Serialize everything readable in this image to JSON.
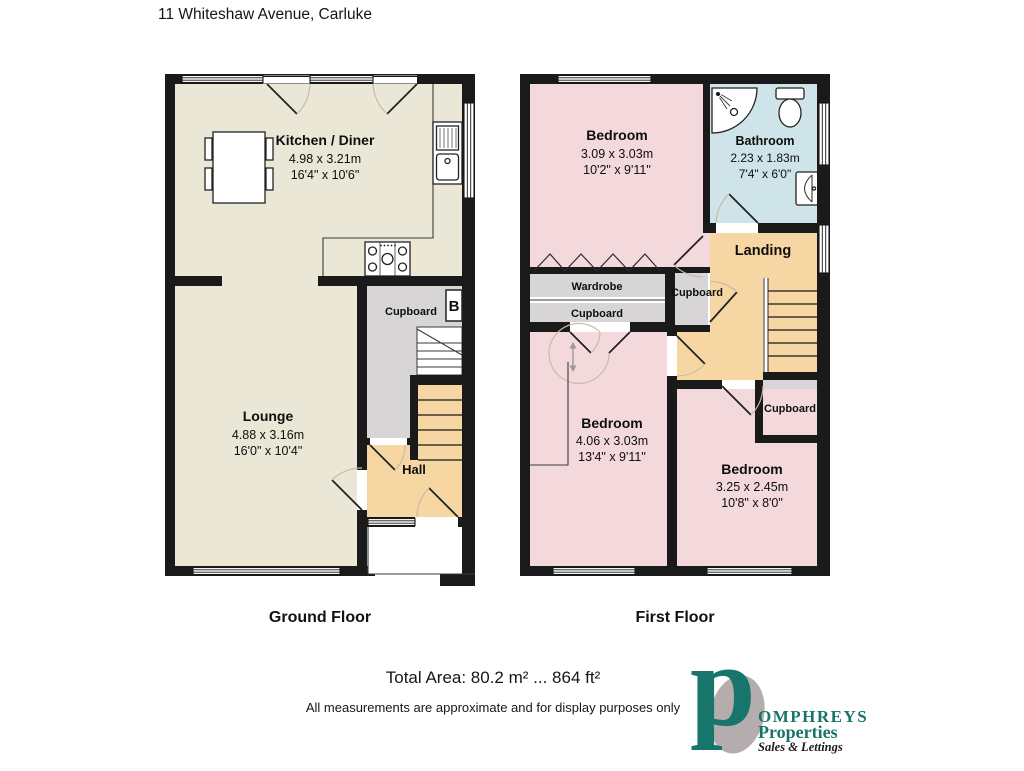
{
  "title": "11 Whiteshaw Avenue, Carluke",
  "ground": {
    "label": "Ground Floor",
    "kitchen_name": "Kitchen / Diner",
    "kitchen_metric": "4.98 x 3.21m",
    "kitchen_imperial": "16'4\" x 10'6\"",
    "lounge_name": "Lounge",
    "lounge_metric": "4.88 x 3.16m",
    "lounge_imperial": "16'0\" x 10'4\"",
    "cupboard": "Cupboard",
    "boiler": "B",
    "hall": "Hall"
  },
  "first": {
    "label": "First Floor",
    "bedroom1_name": "Bedroom",
    "bedroom1_metric": "3.09 x 3.03m",
    "bedroom1_imperial": "10'2\" x 9'11\"",
    "bathroom_name": "Bathroom",
    "bathroom_metric": "2.23 x 1.83m",
    "bathroom_imperial": "7'4\" x 6'0\"",
    "landing": "Landing",
    "wardrobe": "Wardrobe",
    "cupboard_a": "Cupboard",
    "cupboard_b": "Cupboard",
    "cupboard_c": "Cupboard",
    "bedroom2_name": "Bedroom",
    "bedroom2_metric": "4.06 x 3.03m",
    "bedroom2_imperial": "13'4\" x 9'11\"",
    "bedroom3_name": "Bedroom",
    "bedroom3_metric": "3.25 x 2.45m",
    "bedroom3_imperial": "10'8\" x 8'0\""
  },
  "footer": {
    "total_area": "Total Area: 80.2 m² ... 864 ft²",
    "disclaimer": "All measurements are approximate and for display purposes only"
  },
  "logo": {
    "initial": "p",
    "name_rest": "OMPHREYS",
    "line2": "Properties",
    "line3": "Sales & Lettings"
  },
  "colors": {
    "wall": "#1a1a1a",
    "beige": "#ebe7d6",
    "pink": "#f3d9dc",
    "blue": "#cfe4e9",
    "tan": "#f6d7a3",
    "gray": "#d7d5d6",
    "teal": "#17756b",
    "logo_gray": "#b5adad"
  }
}
